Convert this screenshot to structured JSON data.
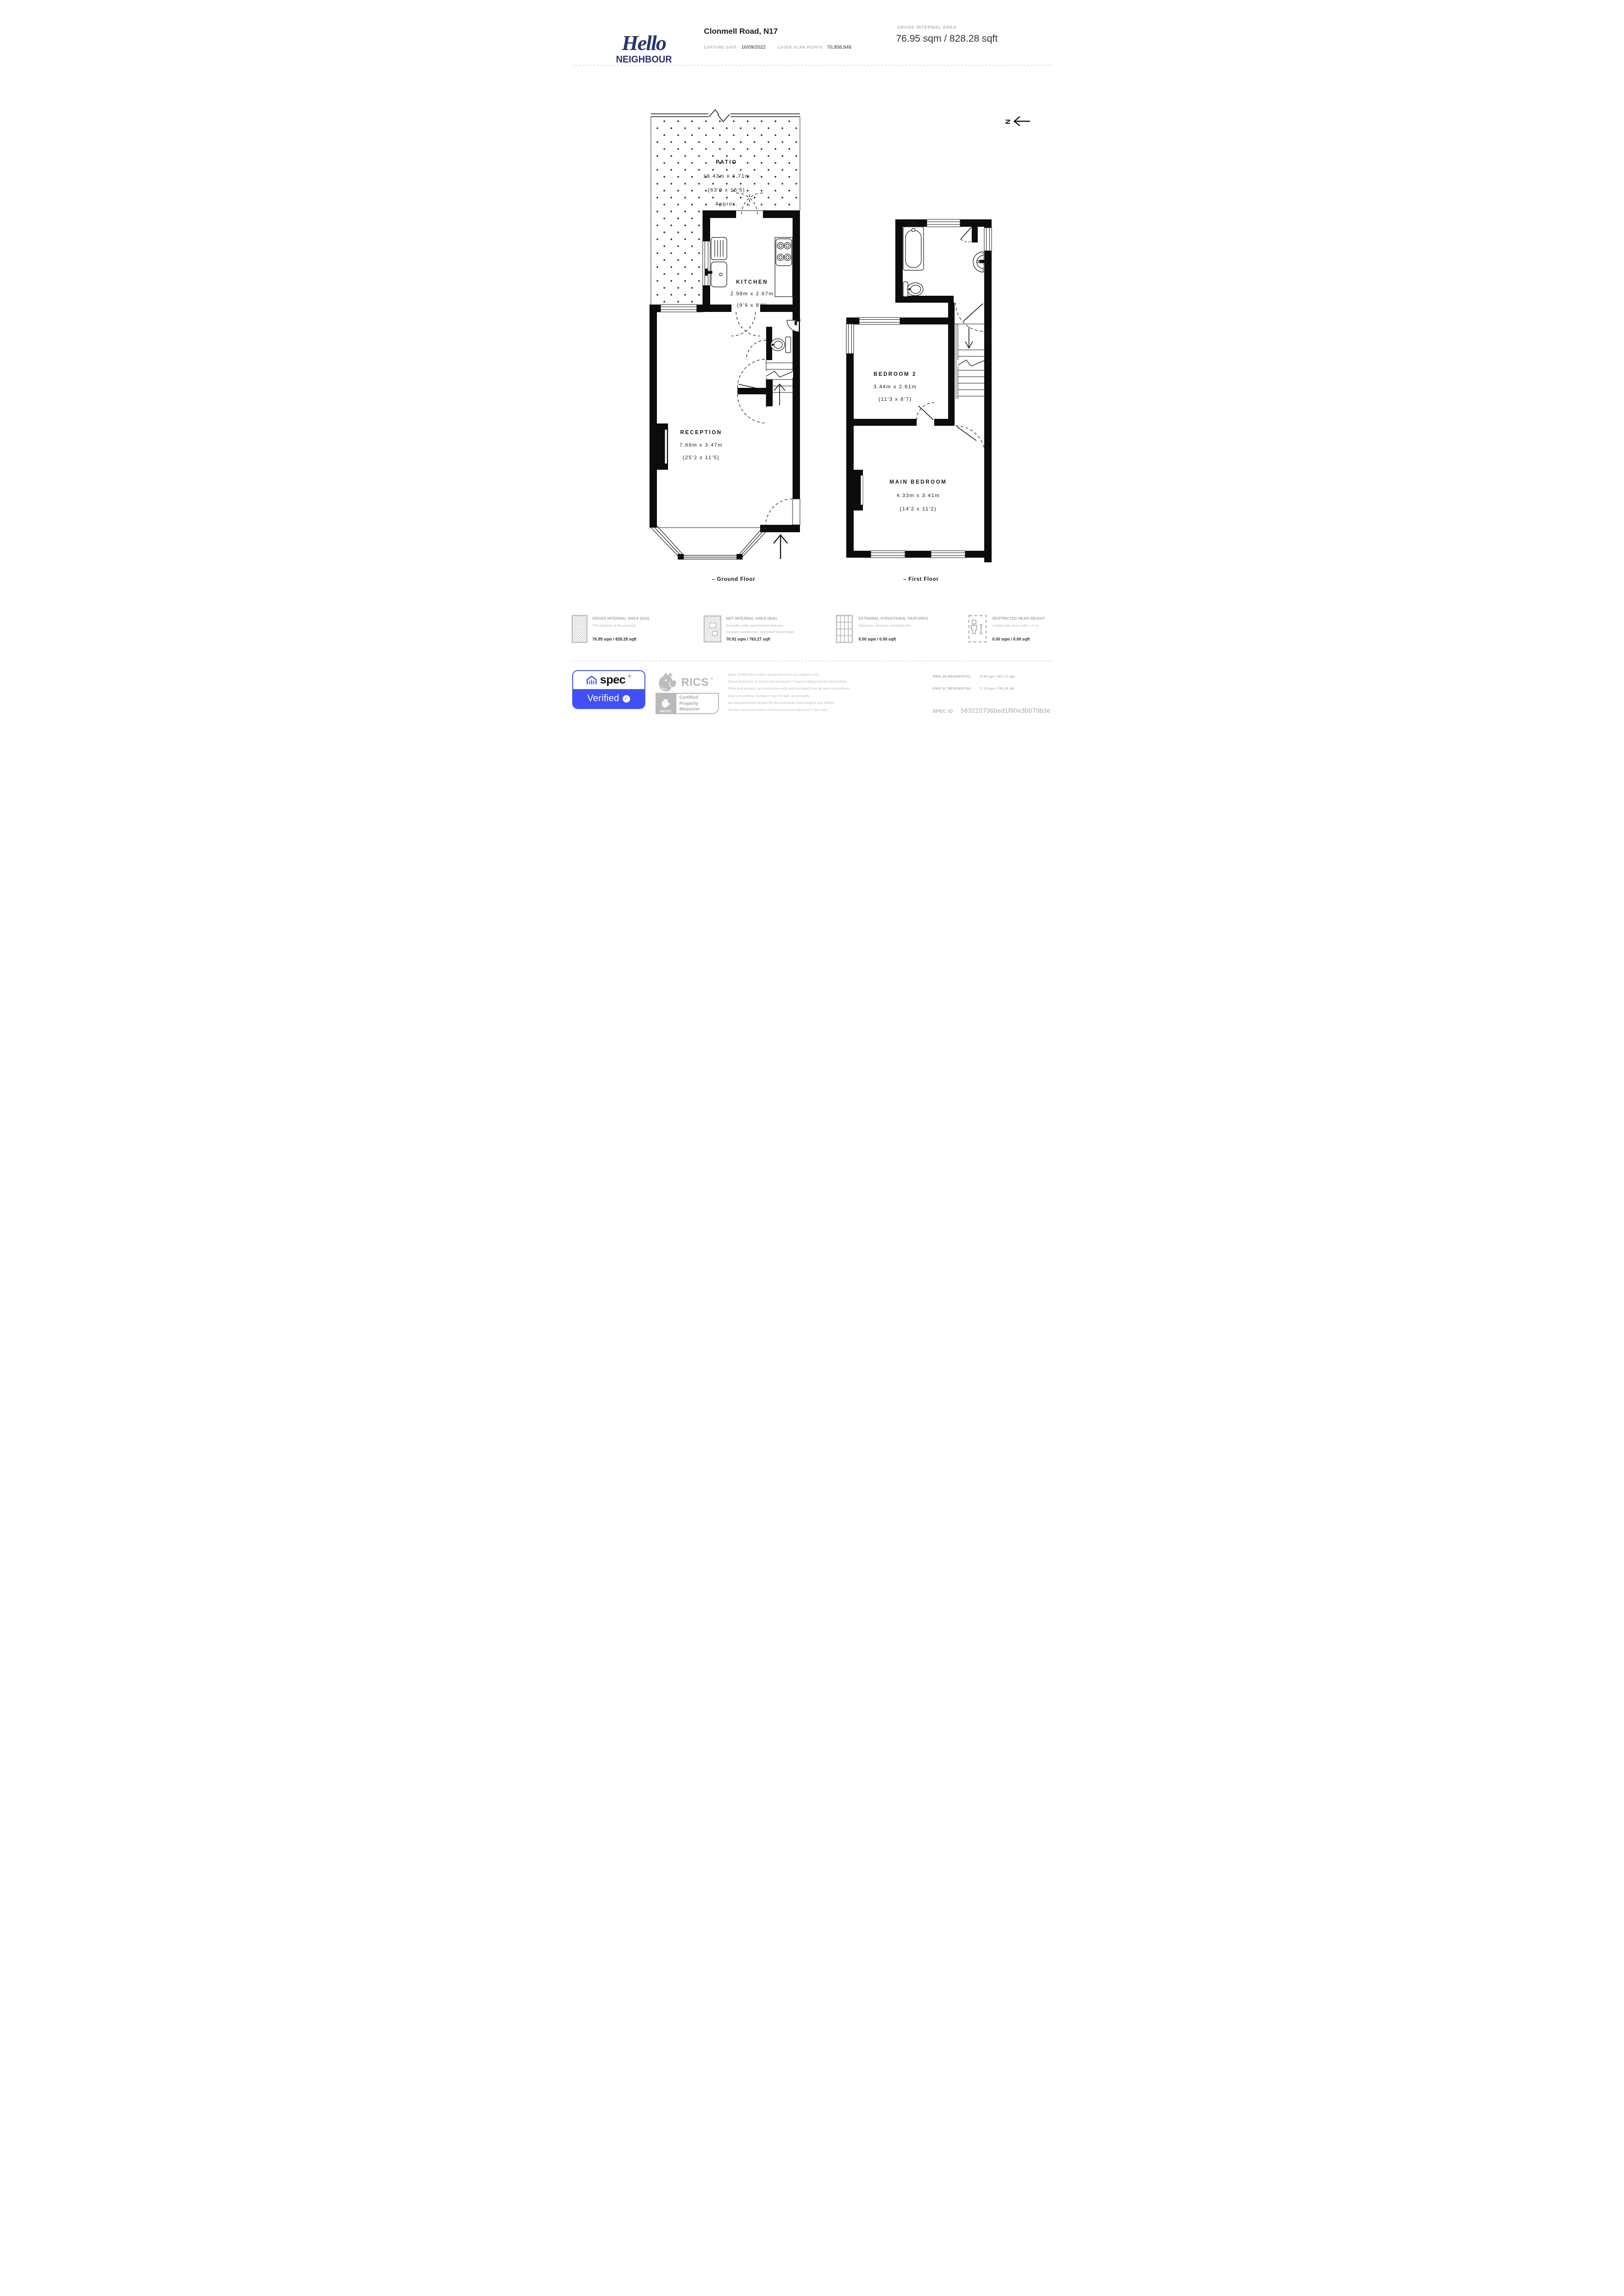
{
  "colors": {
    "brand_navy": "#2b3470",
    "spec_blue": "#4150f5",
    "logo_gray": "#b5b5b5",
    "text_dark": "#1c1c1c",
    "muted_gray": "#b2b2b2",
    "plan_black": "#0c0c0c"
  },
  "header": {
    "logo_script": "Hello",
    "logo_caps": "NEIGHBOUR",
    "address": "Clonmell Road, N17",
    "capture_date_label": "CAPTURE DATE",
    "capture_date_value": "16/09/2022",
    "laser_label": "LASER SCAN POINTS",
    "laser_value": "70,958,848",
    "gia_label": "GROSS INTERNAL AREA",
    "gia_value": "76.95 sqm / 828.28 sqft"
  },
  "plan": {
    "north_label": "N",
    "ground": {
      "caption": "– Ground Floor",
      "rooms": {
        "patio": {
          "name": "PATIO",
          "metric": "19.43m x 4.71m",
          "imperial": "(63'9 x 15'5)",
          "note": "Approx."
        },
        "kitchen": {
          "name": "KITCHEN",
          "metric": "2.98m x 2.67m",
          "imperial": "(9'9 x 8'9)"
        },
        "reception": {
          "name": "RECEPTION",
          "metric": "7.66m x 3.47m",
          "imperial": "(25'2 x 11'5)"
        }
      }
    },
    "first": {
      "caption": "– First Floor",
      "rooms": {
        "bedroom2": {
          "name": "BEDROOM 2",
          "metric": "3.44m x 2.61m",
          "imperial": "(11'3 x 8'7)"
        },
        "main_bedroom": {
          "name": "MAIN BEDROOM",
          "metric": "4.33m x 3.41m",
          "imperial": "(14'2 x 11'2)"
        }
      }
    }
  },
  "legend": {
    "items": [
      {
        "title": "GROSS INTERNAL AREA (GIA)",
        "desc1": "The footprint of the property",
        "desc2": "",
        "value": "76.95 sqm / 828.28 sqft"
      },
      {
        "title": "NET INTERNAL AREA (NIA)",
        "desc1": "Excludes walls and external features",
        "desc2": "Includes washrooms, restricted head height",
        "value": "70.91 sqm / 763.27 sqft"
      },
      {
        "title": "EXTERNAL STRUCTURAL FEATURES",
        "desc1": "Balconies, terraces, verandas etc.",
        "desc2": "",
        "value": "0.00 sqm / 0.00 sqft"
      },
      {
        "title": "RESTRICTED HEAD HEIGHT",
        "desc1": "Limited use area under 1.5 m",
        "desc2": "",
        "value": "0.00 sqm / 0.00 sqft"
      }
    ]
  },
  "footer": {
    "spec_brand": "spec",
    "spec_reg": "®",
    "spec_verified": "Verified",
    "verified_check": "✓",
    "rics_name": "RICS",
    "rics_reg": "®",
    "rics_badge": {
      "mini_label": "RICS®",
      "line1": "Certified",
      "line2": "Property",
      "line3": "Measurer"
    },
    "disclaimer_lines": [
      "Spec Verified floor plans are produced in accordance with",
      "Royal Institution of Chartered Surveyors’ Property Measurement Standards.",
      "Plots and gardens are illustrative only and excluded from all area calculations.",
      "Due to rounding, numbers may not add up precisely.",
      "All measurements shown for the individual room lengths and widths",
      "are the maximum points of measurements captured in the scan."
    ],
    "ipms": [
      {
        "label": "IPMS 3B RESIDENTIAL",
        "value": "74.45 sqm / 801.37 sqft"
      },
      {
        "label": "IPMS 3C RESIDENTIAL",
        "value": "71.18 sqm / 766.18 sqft"
      }
    ],
    "spec_id_label": "SPEC ID",
    "spec_id_value": "563220706bed1f80e3b070b3e"
  }
}
